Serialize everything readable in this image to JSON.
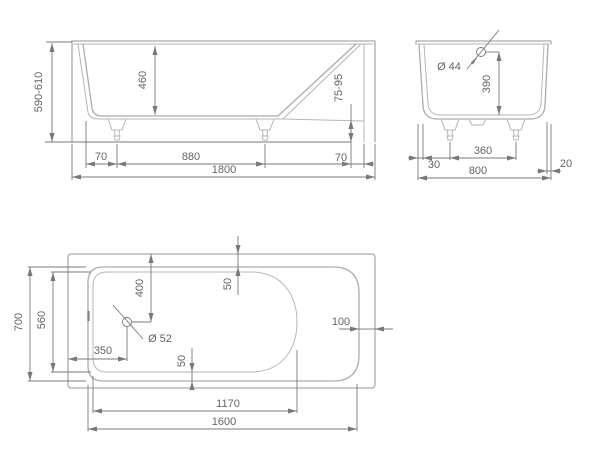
{
  "document_type": "bathtub technical drawing",
  "colors": {
    "background": "#ffffff",
    "outline": "#a8acb0",
    "dimension_lines": "#74797d",
    "dimension_text": "#5f6468"
  },
  "views": {
    "side": {
      "name": "side elevation view",
      "dims": {
        "height_range": "590-610",
        "inner_depth": "460",
        "feet_height_range": "75-95",
        "left_floor_offset": "70",
        "feet_spacing": "880",
        "right_floor_offset": "70",
        "total_length": "1800"
      }
    },
    "end": {
      "name": "end elevation view",
      "dims": {
        "overflow_diameter": "Ø 44",
        "overflow_height": "390",
        "left_offset": "30",
        "feet_spacing": "360",
        "rim_overhang": "20",
        "total_width": "800"
      }
    },
    "plan": {
      "name": "top plan view",
      "dims": {
        "total_width": "700",
        "floor_width": "560",
        "drain_from_top": "400",
        "rim_top_width": "50",
        "drain_diameter": "Ø 52",
        "drain_from_left": "350",
        "rim_bottom_width": "50",
        "rim_right_width": "100",
        "floor_length": "1170",
        "total_length": "1600"
      }
    }
  }
}
